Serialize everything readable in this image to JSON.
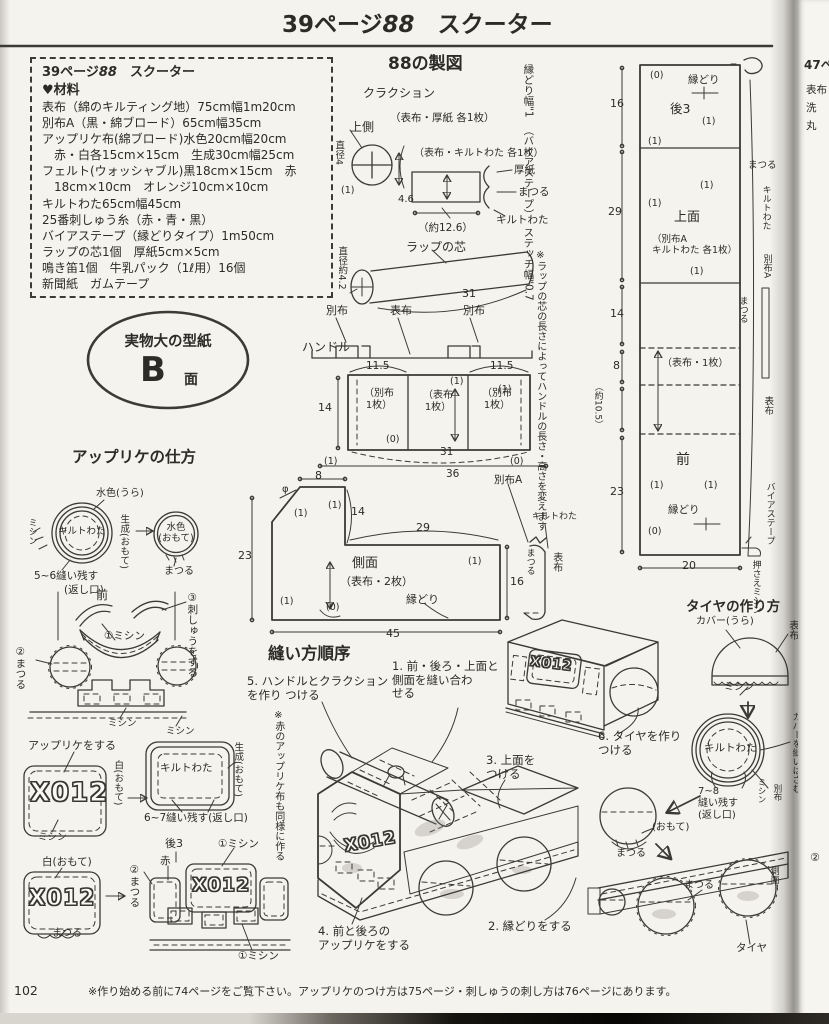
{
  "header": {
    "page_ref": "39ページ",
    "number": "88",
    "title": "スクーター"
  },
  "materials": {
    "box_ref": "39ページ",
    "box_num": "88",
    "box_name": "スクーター",
    "heading": "♥材料",
    "lines": [
      "表布（綿のキルティング地）75cm幅1m20cm",
      "別布A（黒・綿ブロード）65cm幅35cm",
      "アップリケ布(綿ブロード)水色20cm幅20cm",
      "　赤・白各15cm×15cm　生成30cm幅25cm",
      "フェルト(ウォッシャブル)黒18cm×15cm　赤",
      "　18cm×10cm　オレンジ10cm×10cm",
      "キルトわた65cm幅45cm",
      "25番刺しゅう糸（赤・青・黒）",
      "バイアステープ（縁どりタイプ）1m50cm",
      "ラップの芯1個　厚紙5cm×5cm",
      "鳴き笛1個　牛乳パック（1ℓ用）16個",
      "新聞紙　ガムテープ"
    ]
  },
  "badge": {
    "caption": "実物大の型紙",
    "letter": "B",
    "suffix": "面"
  },
  "drafting": {
    "heading": "88の製図",
    "edging_note": [
      "縁どり幅\"1",
      "（バイアステープ）",
      "ステッチ幅\"0.7"
    ],
    "horn": {
      "title": "クラクション",
      "upper": "上側",
      "mat1": "（表布・厚紙 各1枚）",
      "dia": "直径4",
      "c1": "(1)",
      "h": "4.6",
      "mat2": "（表布・キルトわた 各1枚）",
      "cardboard": "厚紙",
      "matsuru": "まつる",
      "batting": "キルトわた",
      "approx": "（約12.6）"
    },
    "wrap": {
      "label": "ラップの芯",
      "dia": "直径約4.2",
      "len": "31",
      "note": "※ラップの芯の長さによってハンドルの長さ・高さを変えます"
    },
    "handle": {
      "top_labels": [
        "別布",
        "表布",
        "別布"
      ],
      "label": "ハンドル",
      "w1": "11.5",
      "w2": "11.5",
      "h": "14",
      "c1": "(1)",
      "c2": "(1)",
      "cell_left": "（別布\n1枚）",
      "cell_mid": "（表布\n1枚）",
      "cell_right": "（別布\n1枚）",
      "c0": "(0)",
      "c3": "(1)",
      "c4": "(0)",
      "w31": "31",
      "w36": "36"
    },
    "side": {
      "w8": "8",
      "phi": "φ",
      "c1": "(1)",
      "c2": "(1)",
      "h14": "14",
      "w29": "29",
      "name": "側面",
      "mat": "（表布・2枚）",
      "c3": "(1)",
      "h16": "16",
      "edging": "縁どり",
      "c0": "(0)",
      "c4": "(1)",
      "w45": "45",
      "h23": "23",
      "cloth_a": "別布A",
      "batting": "キルトわた",
      "matsuru": "まつる",
      "fabric": "表布"
    },
    "tall": {
      "d16": "16",
      "d29": "29",
      "d14": "14",
      "d8": "8",
      "d105": "（約10.5）",
      "d23": "23",
      "d20": "20",
      "c0": "(0)",
      "edging_top": "縁どり",
      "back": "後3",
      "c1": "(1)",
      "c2": "(1)",
      "c3": "(1)",
      "c4": "(1)",
      "top_name": "上面",
      "top_mat": "（別布A\nキルトわた 各1枚）",
      "c5": "(1)",
      "mid_mat": "（表布・1枚）",
      "front": "前",
      "c6": "(1)",
      "c7": "(1)",
      "edging_bot": "縁どり",
      "c8": "(0)",
      "matsuru1": "まつる",
      "batting": "キルトわた",
      "cloth_a": "別布A",
      "matsuru2": "まつる",
      "fabric": "表布",
      "bias": "バイアステープ",
      "press": "押さえミシン"
    }
  },
  "applique": {
    "heading": "アップリケの仕方",
    "circle": {
      "back": "水色(うら)",
      "batting": "キルトわた",
      "machine": "ミシン",
      "base": "生成(おもて)",
      "front": "水色\n(おもて)",
      "matsuru": "まつる",
      "leave": "5~6縫い残す",
      "opening": "(返し口)"
    },
    "face": {
      "front": "前",
      "s1": "①ミシン",
      "s2": "②まつる",
      "s3": "③刺しゅうをする",
      "m1": "ミシン",
      "m2": "ミシン"
    },
    "row1": {
      "do_applique": "アップリケをする",
      "x012": "X012",
      "white": "白(おもて)",
      "machine": "ミシン",
      "batting": "キルトわた",
      "base": "生成(おもて)",
      "leave": "6~7縫い残す(返し口)",
      "note": "※赤のアップリケ布も同様に作る"
    },
    "row2": {
      "white": "白(おもて)",
      "x012": "X012",
      "matsuru": "まつる",
      "back": "後3",
      "s1": "①ミシン",
      "s2": "②まつる",
      "red": "赤",
      "x012b": "X012",
      "m1": "①ミシン"
    }
  },
  "sewing": {
    "heading": "縫い方順序",
    "s5": "5. ハンドルとクラクション\nを作り つける",
    "s1": "1. 前・後ろ・上面と\n側面を縫い合わ\nせる",
    "s6": "6. タイヤを作り\nつける",
    "s3": "3. 上面を\nつける",
    "s2": "2. 縁どりをする",
    "s4": "4. 前と後ろの\nアップリケをする",
    "x012_big": "X012",
    "x012_small": "X012"
  },
  "tire": {
    "heading": "タイヤの作り方",
    "cover": "カバー(うら)",
    "fabric": "表布",
    "machine": "ミシン",
    "batting": "キルトわた",
    "sandwich": "カバーを縫いはさむ",
    "machine2": "ミシン",
    "cloth": "別布",
    "leave": "7~8\n縫い残す\n(返し口)",
    "front": "(おもて)",
    "matsuru": "まつる",
    "attach_matsuru": "まつる",
    "tire_label": "タイヤ",
    "side": "側面"
  },
  "footer": {
    "page_no": "102",
    "note": "※作り始める前に74ページをご覧下さい。アップリケのつけ方は75ページ・刺しゅうの刺し方は76ページにあります。"
  },
  "next_page": {
    "f1": "47ペ",
    "f2": "表布",
    "f3": "洗",
    "f4": "丸",
    "f5": "②"
  }
}
